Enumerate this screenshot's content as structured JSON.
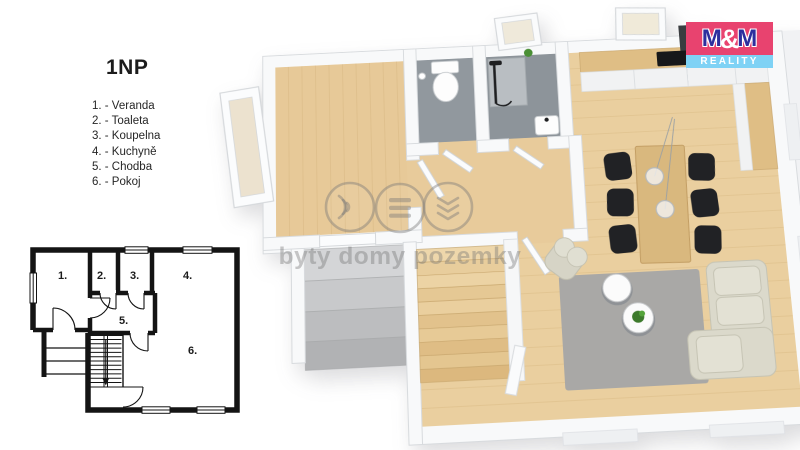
{
  "legend": {
    "title": "1NP",
    "items": [
      "1. - Veranda",
      "2. - Toaleta",
      "3. - Koupelna",
      "4. - Kuchyně",
      "5. - Chodba",
      "6. - Pokoj"
    ]
  },
  "plan2d": {
    "rooms": [
      "1.",
      "2.",
      "3.",
      "4.",
      "5.",
      "6."
    ]
  },
  "watermark": {
    "text": "byty domy pozemky"
  },
  "logo": {
    "m1": "M",
    "amp": "&",
    "m2": "M",
    "reality": "REALITY"
  },
  "colors": {
    "logo_top_bg": "#e8436f",
    "logo_bottom_bg": "#7fd2f5",
    "logo_m": "#2d2f9e",
    "wood_floor": "#eacf9f",
    "wood_plank_line": "#d9b983",
    "stair_wood": "#e3c28e",
    "bath_floor": "#91989e",
    "wall_white": "#f8f9fa",
    "wall_edge": "#d8dbde",
    "rug_gray": "#a9a8a6",
    "sofa_cream": "#dbd9cb",
    "chair_black": "#212225",
    "plant_green": "#3d7a2c",
    "plan_line": "#141414"
  }
}
